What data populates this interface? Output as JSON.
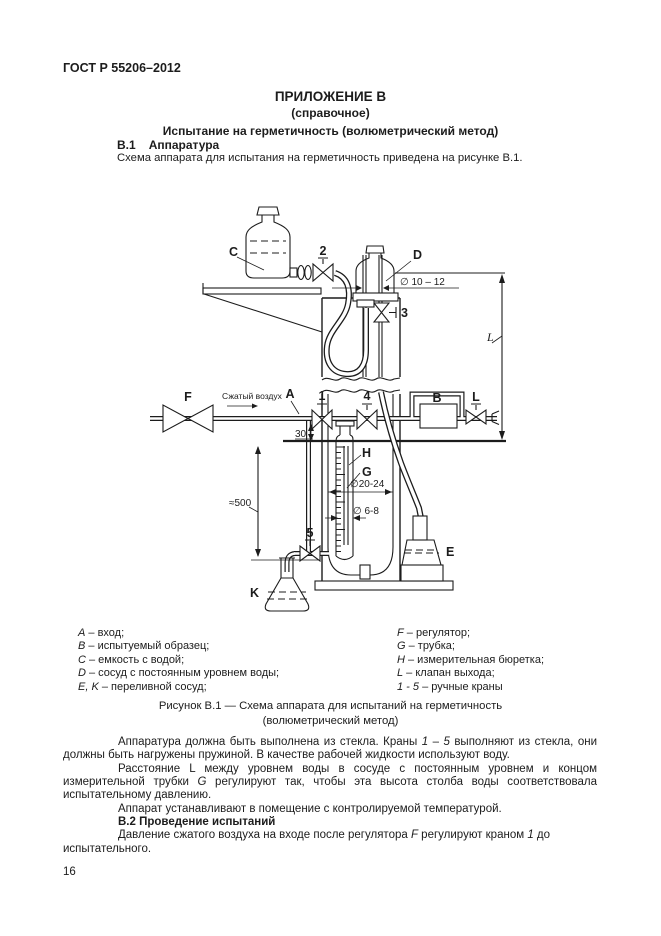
{
  "colors": {
    "ink": "#1c1c1c",
    "paper": "#ffffff"
  },
  "page": {
    "standard_ref": "ГОСТ Р 55206–2012",
    "page_number": "16"
  },
  "appendix": {
    "title": "ПРИЛОЖЕНИЕ В",
    "subtitle": "(справочное)",
    "section_title": "Испытание на герметичность (волюметрический метод)",
    "s1_num": "В.1",
    "s1_name": "Аппаратура",
    "s1_intro": "Схема аппарата для испытания на герметичность приведена на рисунке В.1."
  },
  "figure": {
    "labels": {
      "c": "C",
      "d": "D",
      "e": "E",
      "k": "K",
      "f": "F",
      "a": "A",
      "b": "B",
      "h": "H",
      "g": "G",
      "valve_1": "1",
      "valve_2": "2",
      "valve_3": "3",
      "valve_4": "4",
      "valve_5": "5",
      "outlet_valve": "L",
      "distance": "L",
      "compressed_air": "Сжатый воздух",
      "dim_d_tube": "∅ 10 – 12",
      "dim_jacket": "∅20-24",
      "dim_burette": "∅ 6-8",
      "dim_height": "≈500",
      "dim_offset": "30"
    },
    "legend_left": [
      [
        {
          "t": "A",
          "i": true
        },
        {
          "t": " – вход;"
        }
      ],
      [
        {
          "t": "B",
          "i": true
        },
        {
          "t": " – испытуемый образец;"
        }
      ],
      [
        {
          "t": "C",
          "i": true
        },
        {
          "t": " – емкость с водой;"
        }
      ],
      [
        {
          "t": "D",
          "i": true
        },
        {
          "t": " – сосуд с постоянным уровнем воды;"
        }
      ],
      [
        {
          "t": "E, K",
          "i": true
        },
        {
          "t": " – переливной сосуд;"
        }
      ]
    ],
    "legend_right": [
      [
        {
          "t": "F",
          "i": true
        },
        {
          "t": " – регулятор;"
        }
      ],
      [
        {
          "t": "G",
          "i": true
        },
        {
          "t": " – трубка;"
        }
      ],
      [
        {
          "t": "H",
          "i": true
        },
        {
          "t": " – измерительная бюретка;"
        }
      ],
      [
        {
          "t": "L",
          "i": true
        },
        {
          "t": " – клапан выхода;"
        }
      ],
      [
        {
          "t": "1 - 5",
          "i": true
        },
        {
          "t": " – ручные краны"
        }
      ]
    ],
    "caption_line1": "Рисунок В.1 — Схема аппарата для испытаний на герметичность",
    "caption_line2": "(волюметрический метод)"
  },
  "body": {
    "p1": [
      {
        "t": "Аппаратура должна быть выполнена из стекла. Краны "
      },
      {
        "t": "1",
        "i": true
      },
      {
        "t": " – "
      },
      {
        "t": "5",
        "i": true
      },
      {
        "t": " выполняют из стекла, они должны быть нагружены пружиной. В качестве рабочей жидкости используют воду."
      }
    ],
    "p2": [
      {
        "t": "Расстояние L между уровнем воды в сосуде с постоянным уровнем и концом измерительной трубки "
      },
      {
        "t": "G",
        "i": true
      },
      {
        "t": " регулируют так, чтобы эта высота столба воды соответствовала испытательному давлению."
      }
    ],
    "p3": [
      {
        "t": "Аппарат устанавливают в помещение с контролируемой температурой."
      }
    ],
    "s2_heading": "В.2 Проведение испытаний",
    "p4": [
      {
        "t": "Давление сжатого воздуха на входе после регулятора "
      },
      {
        "t": "F",
        "i": true
      },
      {
        "t": " регулируют краном "
      },
      {
        "t": "1",
        "i": true
      },
      {
        "t": " до"
      },
      {
        "br": true
      },
      {
        "t": "испытательного."
      }
    ]
  }
}
